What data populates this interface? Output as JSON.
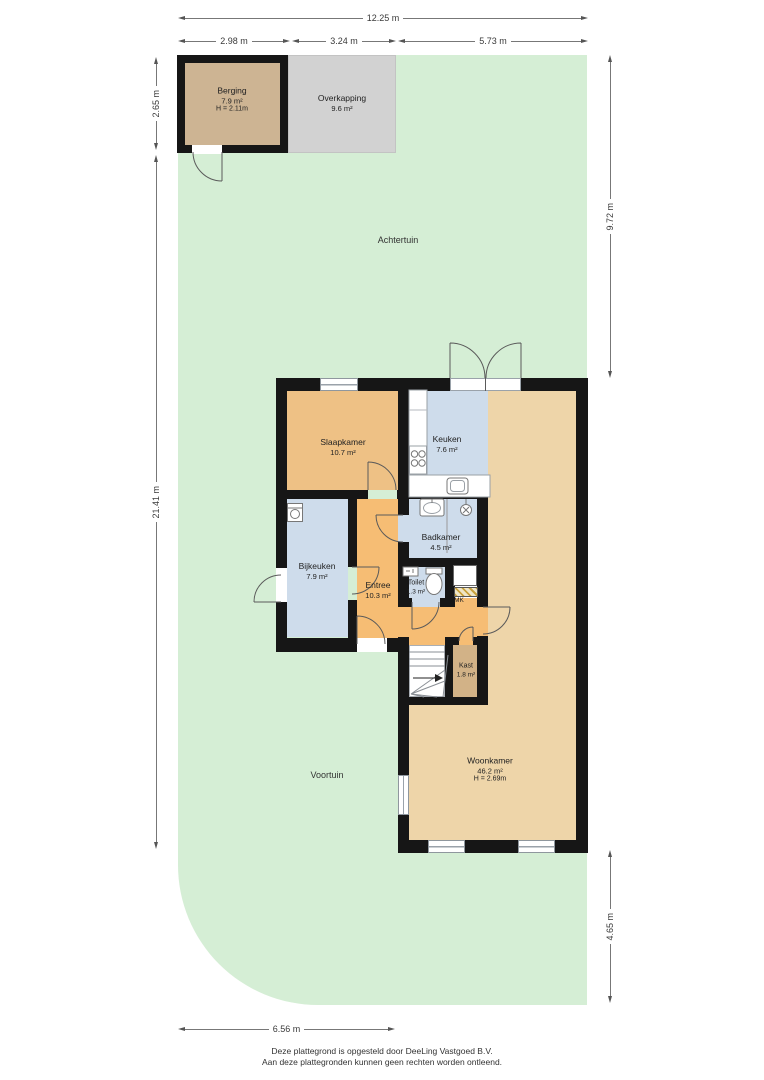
{
  "colors": {
    "wall": "#161616",
    "garden": "#d5eed5",
    "berging": "#cdb493",
    "overkapping": "#d2d2d2",
    "slaapkamer": "#eec185",
    "entree": "#f6bd74",
    "woonkamer": "#eed5a9",
    "kast": "#d2b287",
    "wetroom": "#cedceb"
  },
  "garden": {
    "back": "Achtertuin",
    "front": "Voortuin"
  },
  "outbuildings": {
    "berging": {
      "name": "Berging",
      "area": "7.9 m²",
      "height": "H = 2.11m"
    },
    "overkapping": {
      "name": "Overkapping",
      "area": "9.6 m²"
    }
  },
  "rooms": {
    "slaapkamer": {
      "name": "Slaapkamer",
      "area": "10.7 m²"
    },
    "keuken": {
      "name": "Keuken",
      "area": "7.6 m²"
    },
    "badkamer": {
      "name": "Badkamer",
      "area": "4.5 m²"
    },
    "bijkeuken": {
      "name": "Bijkeuken",
      "area": "7.9 m²"
    },
    "entree": {
      "name": "Entree",
      "area": "10.3 m²"
    },
    "toilet": {
      "name": "Toilet",
      "area": "1.3 m²"
    },
    "meterkast": {
      "name": "MK"
    },
    "kast": {
      "name": "Kast",
      "area": "1.8 m²"
    },
    "woonkamer": {
      "name": "Woonkamer",
      "area": "46.2 m²",
      "height": "H = 2.69m"
    }
  },
  "dimensions": {
    "total_width": "12.25 m",
    "berging_width": "2.98 m",
    "overkapping_width": "3.24 m",
    "right_garden_width": "5.73 m",
    "berging_depth": "2.65 m",
    "left_height": "21.41 m",
    "right_top_height": "9.72 m",
    "right_bottom_height": "4.65 m",
    "front_width": "6.56 m"
  },
  "footer": {
    "line1": "Deze plattegrond is opgesteld door DeeLing Vastgoed B.V.",
    "line2": "Aan deze plattegronden kunnen geen rechten worden ontleend."
  }
}
